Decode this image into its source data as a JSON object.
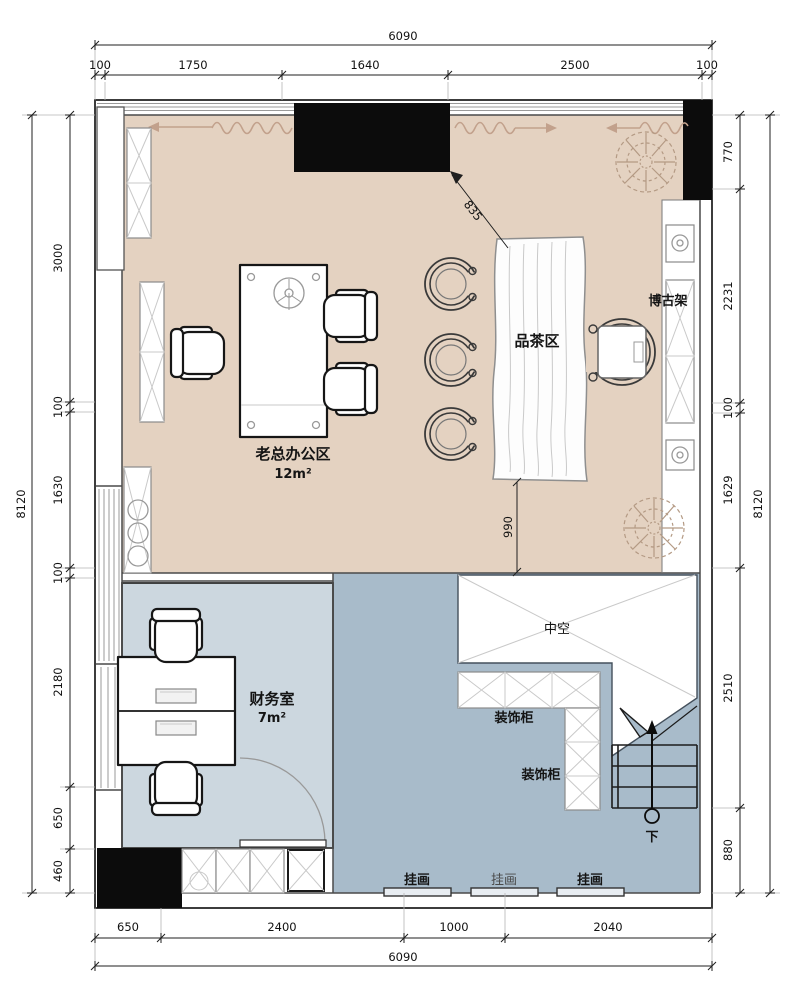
{
  "plan": {
    "labels": {
      "boss_office": "老总办公区",
      "boss_office_area": "12m²",
      "tea_area": "品茶区",
      "antique_shelf": "博古架",
      "finance_room": "财务室",
      "finance_room_area": "7m²",
      "void": "中空",
      "deco_cabinet_1": "装饰柜",
      "deco_cabinet_2": "装饰柜",
      "painting_1": "挂画",
      "painting_2": "挂画",
      "painting_3": "挂画",
      "stair_down": "下"
    },
    "dims": {
      "top_total": "6090",
      "top": [
        "100",
        "1750",
        "1640",
        "2500",
        "100"
      ],
      "left_total": "8120",
      "left": [
        "3000",
        "100",
        "1630",
        "100",
        "2180",
        "650",
        "460"
      ],
      "right": [
        "770",
        "2231",
        "100",
        "1629",
        "2510",
        "880"
      ],
      "right_total": "8120",
      "bottom": [
        "650",
        "2400",
        "1000",
        "2040"
      ],
      "bottom_total": "6090",
      "diag": "835",
      "table_offset": "990"
    },
    "colors": {
      "floor_tan": "#e4d2c1",
      "finance_blue": "#ccd7df",
      "hall_blue": "#a8bbca",
      "wall_black": "#0c0c0c",
      "curtain_brown": "#c2a18c"
    }
  }
}
